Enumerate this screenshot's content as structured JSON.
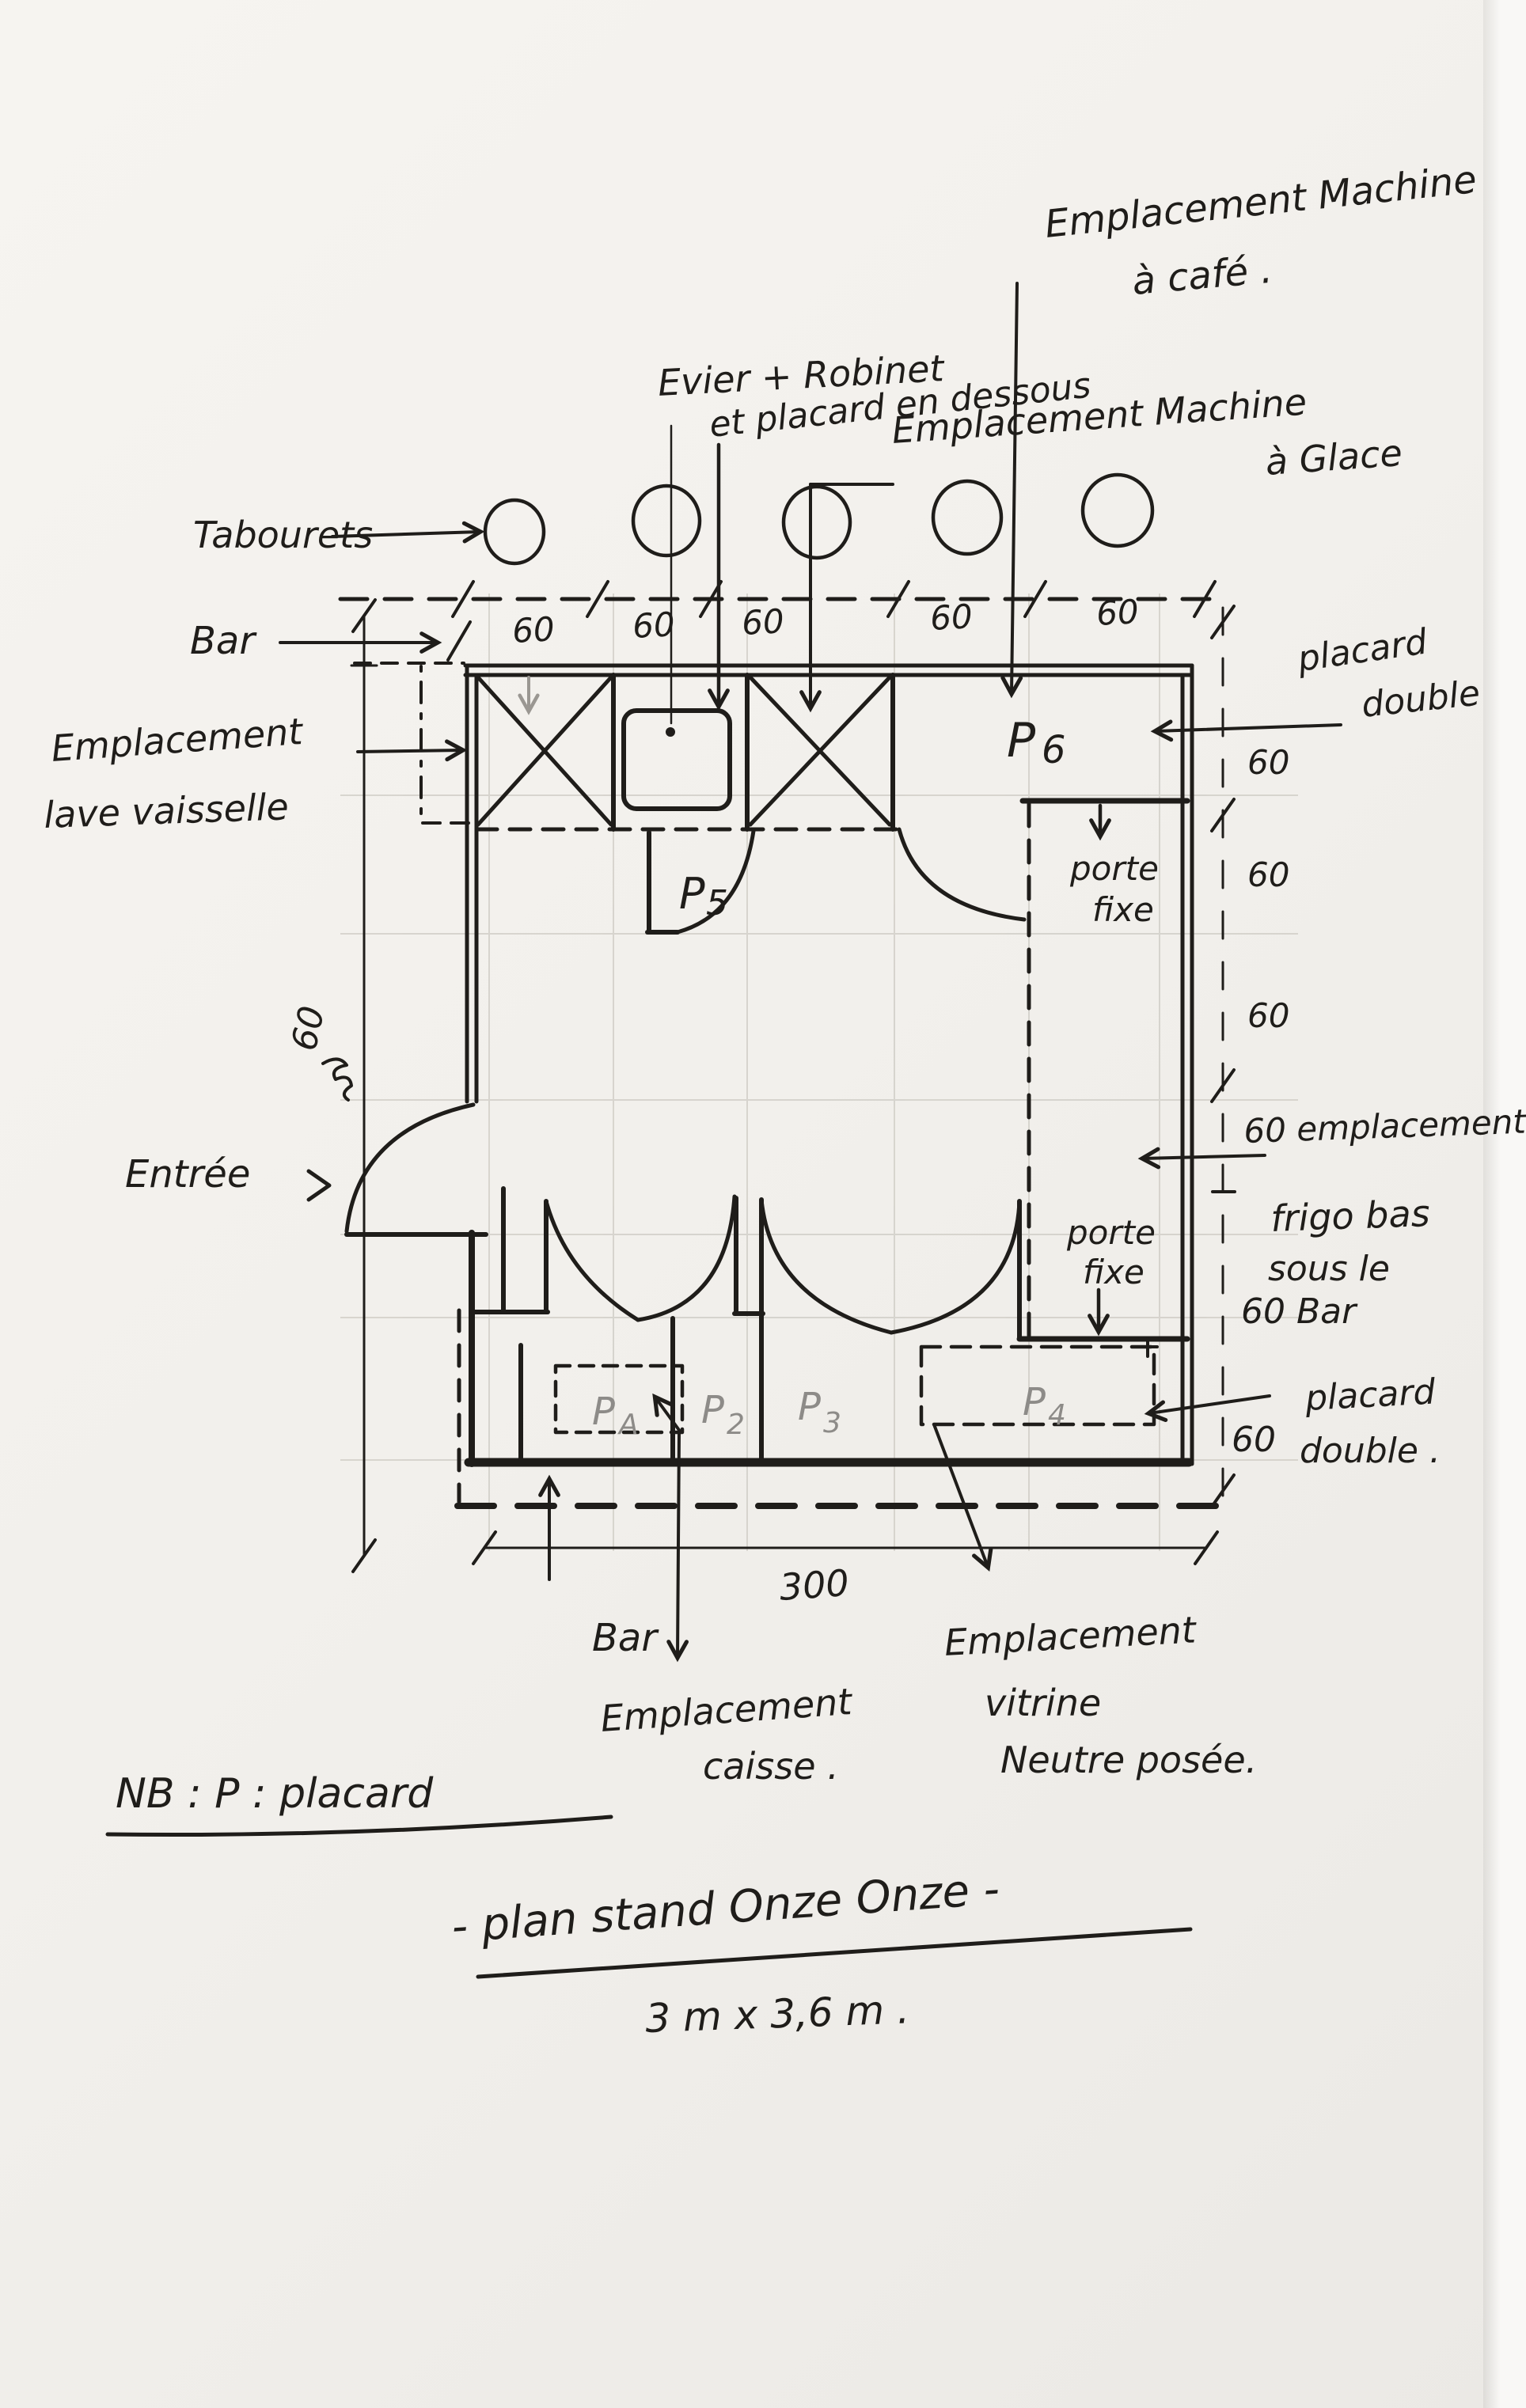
{
  "colors": {
    "ink": "#1f1d1a",
    "pencil": "#8d8b88",
    "paper": "#f2f0ec"
  },
  "title": {
    "main": "- plan stand Onze Onze -",
    "dimensions": "3 m x 3,6 m ."
  },
  "note": {
    "nb": "NB : P : placard"
  },
  "annotations": {
    "machine_cafe": {
      "line1": "Emplacement Machine",
      "line2": "à café ."
    },
    "evier": {
      "line1": "Evier + Robinet",
      "line2": "et placard en dessous"
    },
    "machine_glace": {
      "line1": "Emplacement Machine",
      "line2": "à Glace"
    },
    "tabourets": "Tabourets",
    "bar_top": "Bar",
    "lave_vaisselle": {
      "line1": "Emplacement",
      "line2": "lave vaisselle"
    },
    "placard_double_top": {
      "line1": "placard",
      "line2": "double"
    },
    "porte_fixe_top": {
      "line1": "porte",
      "line2": "fixe"
    },
    "entree": "Entrée",
    "frigo": {
      "line1": "60 emplacement",
      "line2": "frigo bas",
      "line3": "sous le",
      "line4": "60 Bar"
    },
    "porte_fixe_bottom": {
      "line1": "porte",
      "line2": "fixe"
    },
    "placard_double_bottom": {
      "line1": "placard",
      "line2": "double ."
    },
    "bar_bottom": "Bar",
    "caisse": {
      "line1": "Emplacement",
      "line2": "caisse ."
    },
    "vitrine": {
      "line1": "Emplacement",
      "line2": "vitrine",
      "line3": "Neutre posée."
    }
  },
  "placards": {
    "p5": {
      "main": "P",
      "sub": "5"
    },
    "p6": {
      "main": "P",
      "sub": "6"
    },
    "pa": {
      "main": "P",
      "sub": "A"
    },
    "p2": {
      "main": "P",
      "sub": "2"
    },
    "p3": {
      "main": "P",
      "sub": "3"
    },
    "p4": {
      "main": "P",
      "sub": "4"
    }
  },
  "dimensions": {
    "top": [
      "60",
      "60",
      "60",
      "60",
      "60"
    ],
    "right": [
      "60",
      "60",
      "60"
    ],
    "right_bottom": "60",
    "left_side": "60",
    "bottom_total": "300"
  }
}
